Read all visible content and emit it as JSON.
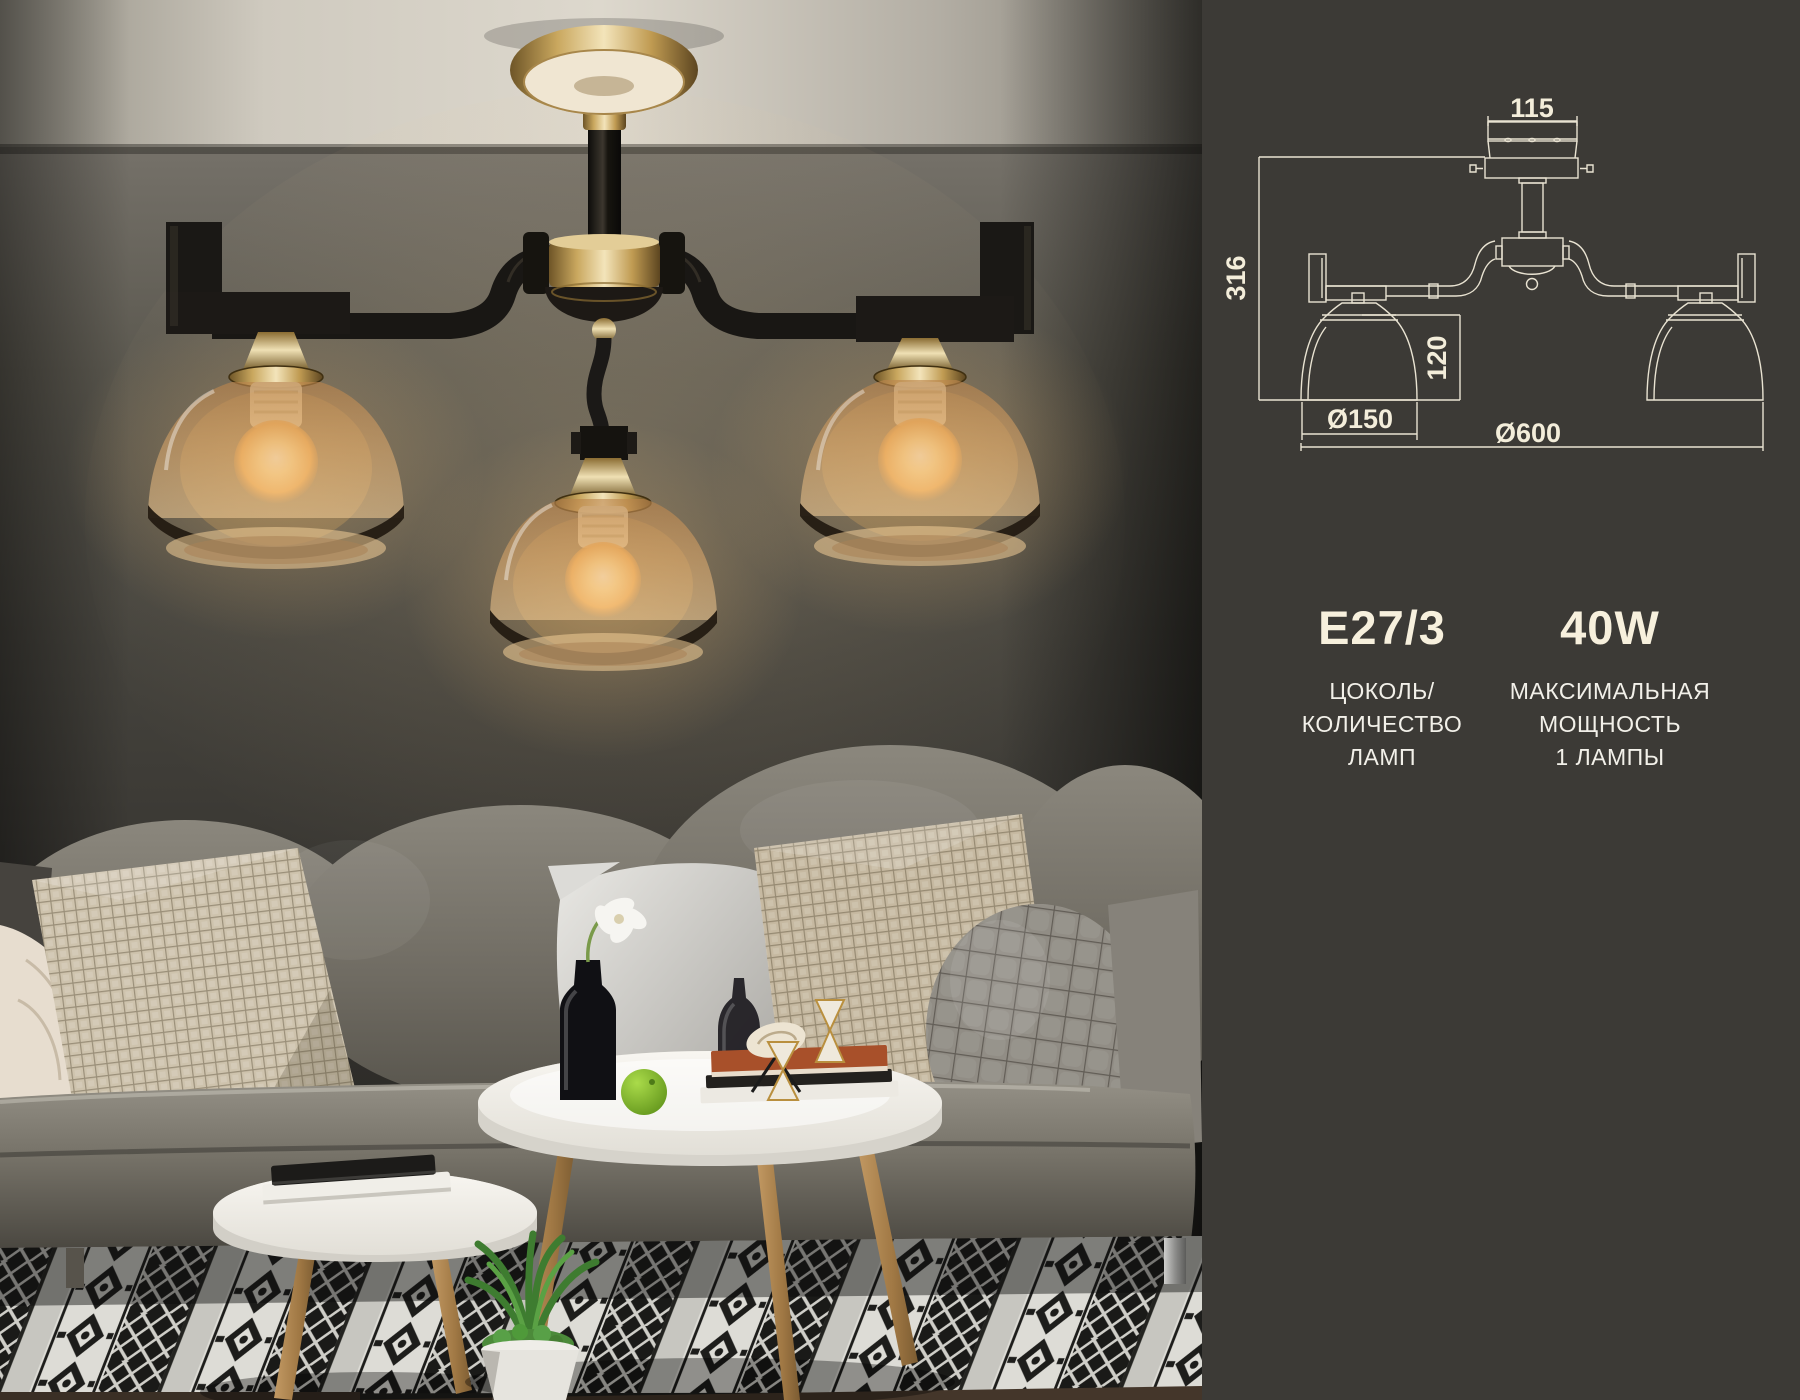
{
  "panel": {
    "background_color": "#3c3a36",
    "line_color": "#e9e3d2",
    "text_color": "#f6efdc",
    "drawing": {
      "dim_canopy_width": "115",
      "dim_total_height": "316",
      "dim_shade_height": "120",
      "dim_shade_diameter": "Ø150",
      "dim_total_diameter": "Ø600"
    },
    "specs": [
      {
        "value": "E27/3",
        "caption_lines": [
          "ЦОКОЛЬ/",
          "КОЛИЧЕСТВО",
          "ЛАМП"
        ]
      },
      {
        "value": "40W",
        "caption_lines": [
          "МАКСИМАЛЬНАЯ",
          "МОЩНОСТЬ",
          "1 ЛАМПЫ"
        ]
      }
    ]
  },
  "photo": {
    "colors": {
      "brass": "#c9a85c",
      "amber_glass": "#d79a55",
      "black_metal": "#1b1815",
      "wall": "#4a4843",
      "sofa": "#7d7970",
      "rug_black": "#1a1a18",
      "rug_light": "#d3d2cc"
    }
  }
}
